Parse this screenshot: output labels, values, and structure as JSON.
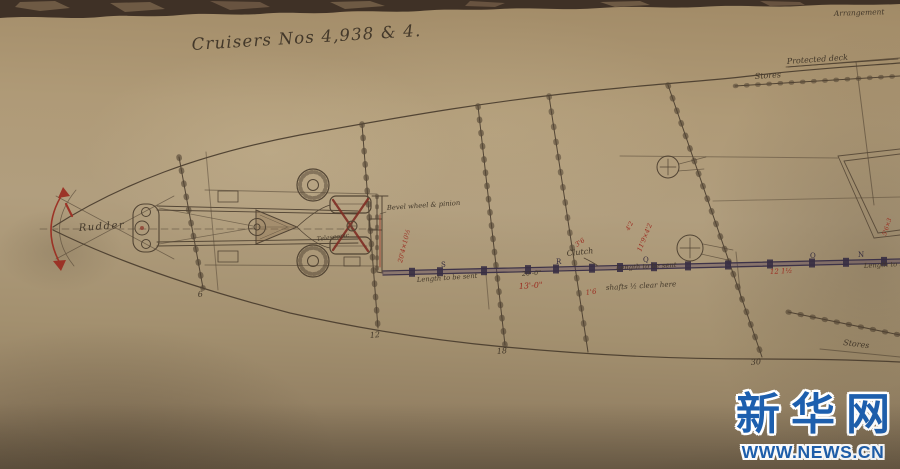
{
  "colors": {
    "paper": "#ab9878",
    "ink": "#43382a",
    "red_ink": "#9b2c20",
    "shaft_ink": "#352b45",
    "watermark_blue": "#1d5fae"
  },
  "title": "Cruisers Nos 4,938 & 4.",
  "corner_note": "Arrangement",
  "deck_labels": {
    "protected_deck": "Protected deck",
    "stores_upper": "Stores",
    "stores_lower": "Stores"
  },
  "drawing_labels": {
    "rudder": "Rudder",
    "bevel_wheel": "Bevel wheel & pinion",
    "telescopic": "Telescopic",
    "clutch": "Clutch",
    "length_note_1": "Length to be sent",
    "length_note_2": "Length to be sent",
    "length_note_3": "Length to be sent",
    "shafts_clear": "shafts ½ clear here"
  },
  "dimensions": {
    "black_20_0": "20'-0\"",
    "red_13_0": "13'-0\"",
    "red_12_1h": "12 1½",
    "red_1_6": "1'6",
    "red_3_6": "3'6"
  },
  "red_notes": {
    "wall": "20'4×10½",
    "near_clutch": "11'9×4'2",
    "near_clutch_2": "4'2",
    "hatch": "5'6×3"
  },
  "stations": [
    "6",
    "12",
    "18",
    "30"
  ],
  "shaft_letters": [
    "S",
    "R",
    "Q",
    "O",
    "N"
  ],
  "watermark": {
    "logo": "新华网",
    "url": "WWW.NEWS.CN"
  }
}
